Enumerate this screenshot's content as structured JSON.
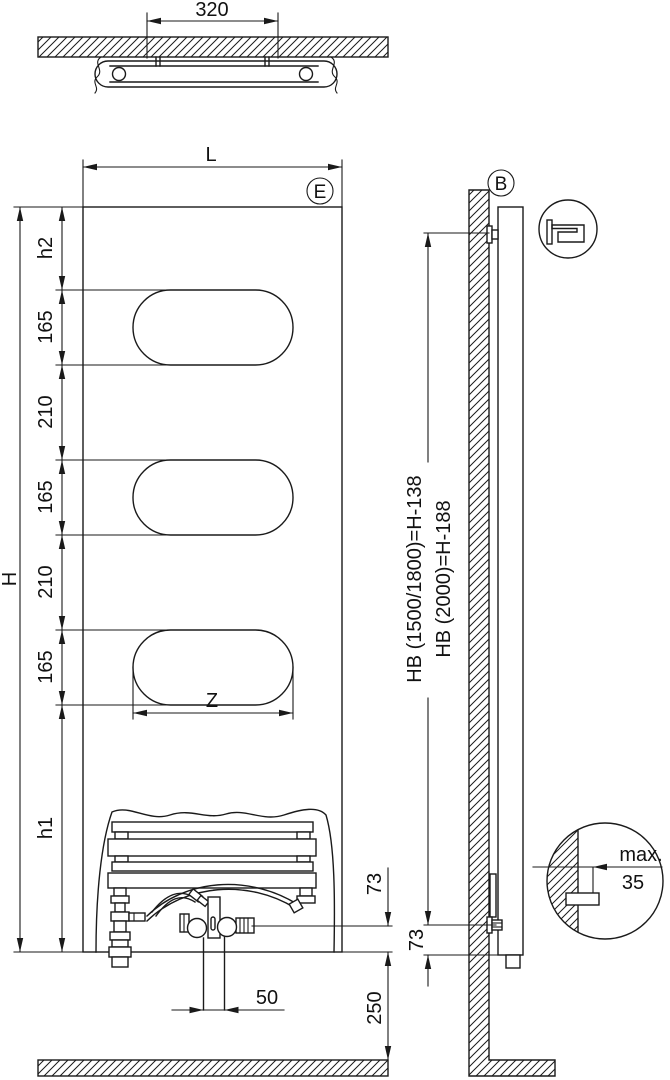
{
  "top_view": {
    "bracket_spacing": "320"
  },
  "front_view": {
    "width_label": "L",
    "detail_marker": "E",
    "height_label": "H",
    "h2_label": "h2",
    "h1_label": "h1",
    "oval_height": "165",
    "oval_gap": "210",
    "oval_width_label": "Z",
    "connection_height": "73",
    "pipe_spacing": "50",
    "floor_clearance": "250"
  },
  "side_view": {
    "detail_marker": "B",
    "bracket_height_1": "HB (1500/1800)=H-138",
    "bracket_height_2": "HB (2000)=H-188",
    "bracket_bottom_offset": "73",
    "wall_clearance_label": "max.",
    "wall_clearance_value": "35"
  }
}
